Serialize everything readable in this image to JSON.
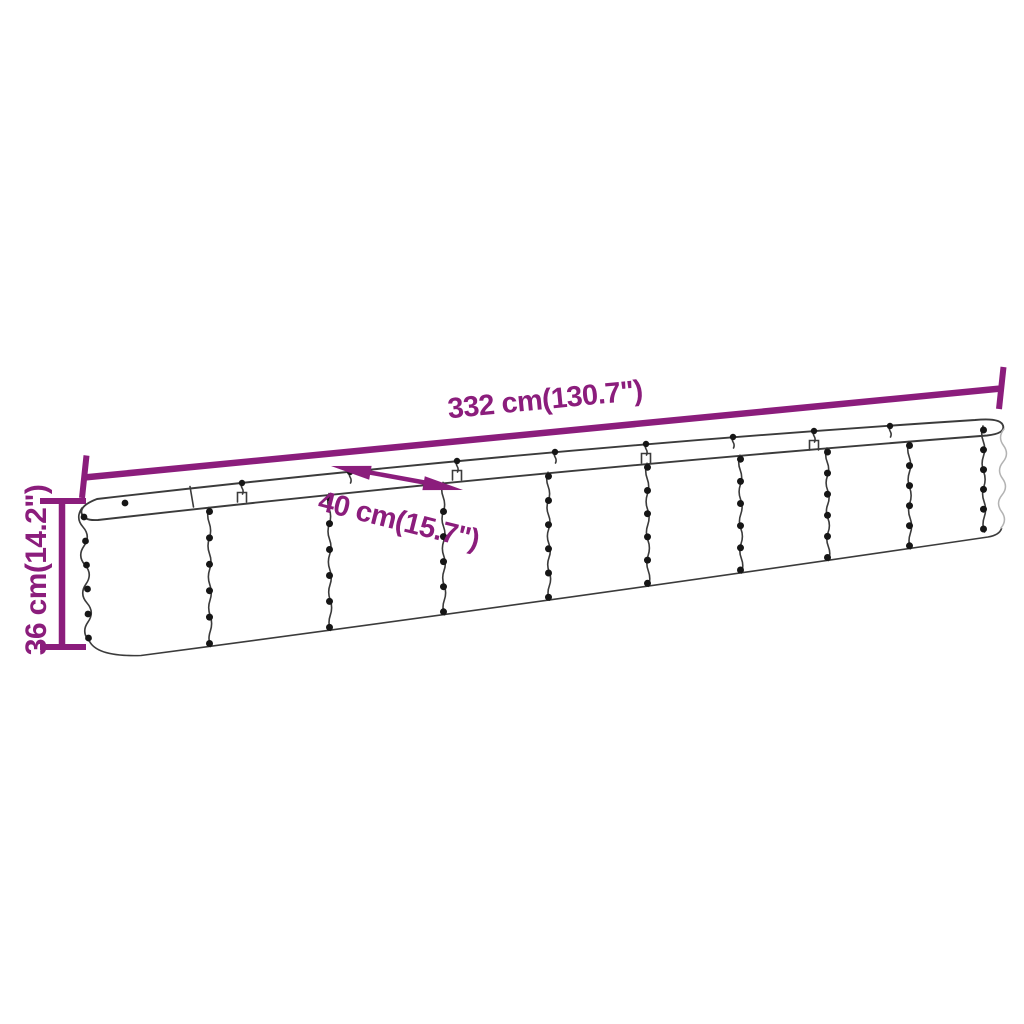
{
  "diagram": {
    "background_color": "#ffffff",
    "accent_color": "#8B1D7C",
    "line_color": "#3B3B3B",
    "light_line_color": "#B3B3B3",
    "dot_color": "#161616",
    "dimensions": {
      "length": {
        "label": "332 cm(130.7\")"
      },
      "width": {
        "label": "40 cm(15.7\")"
      },
      "height": {
        "label": "36 cm(14.2\")"
      }
    }
  }
}
